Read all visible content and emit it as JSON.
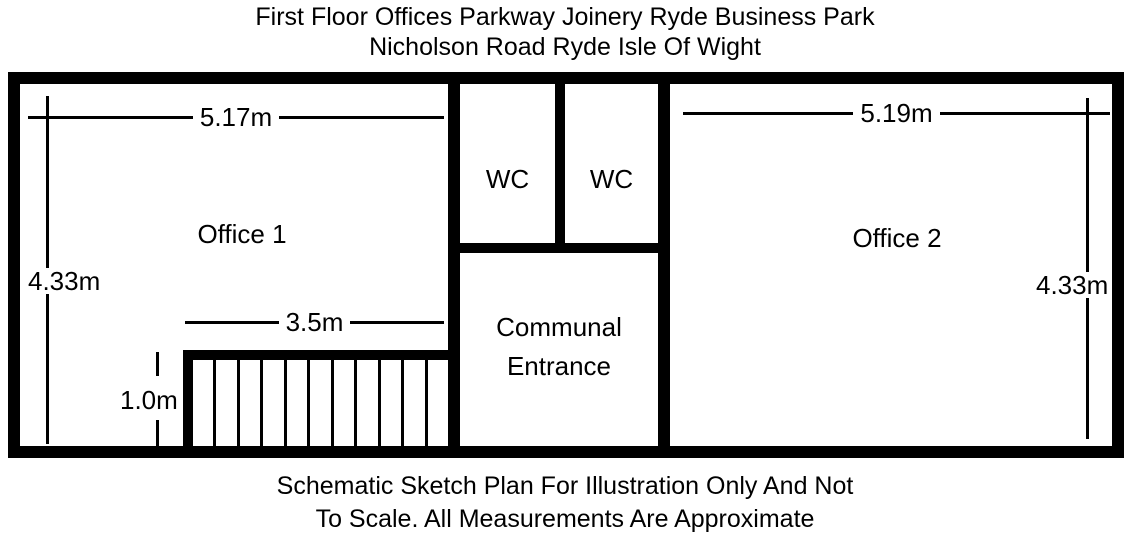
{
  "title": {
    "line1": "First Floor Offices Parkway Joinery Ryde Business Park",
    "line2": "Nicholson Road Ryde Isle Of Wight"
  },
  "footer": {
    "line1": "Schematic Sketch Plan For Illustration Only And Not",
    "line2": "To Scale. All Measurements Are Approximate"
  },
  "rooms": {
    "office1": {
      "label": "Office 1"
    },
    "wc_left": {
      "label": "WC"
    },
    "wc_right": {
      "label": "WC"
    },
    "office2": {
      "label": "Office 2"
    },
    "communal": {
      "line1": "Communal",
      "line2": "Entrance"
    }
  },
  "dimensions": {
    "office1_width": "5.17m",
    "office1_height": "4.33m",
    "office2_width": "5.19m",
    "office2_height": "4.33m",
    "stairs_width": "3.5m",
    "stairs_depth": "1.0m"
  },
  "stairs": {
    "treads": 11
  },
  "colors": {
    "wall": "#000000",
    "background": "#ffffff",
    "text": "#000000"
  }
}
